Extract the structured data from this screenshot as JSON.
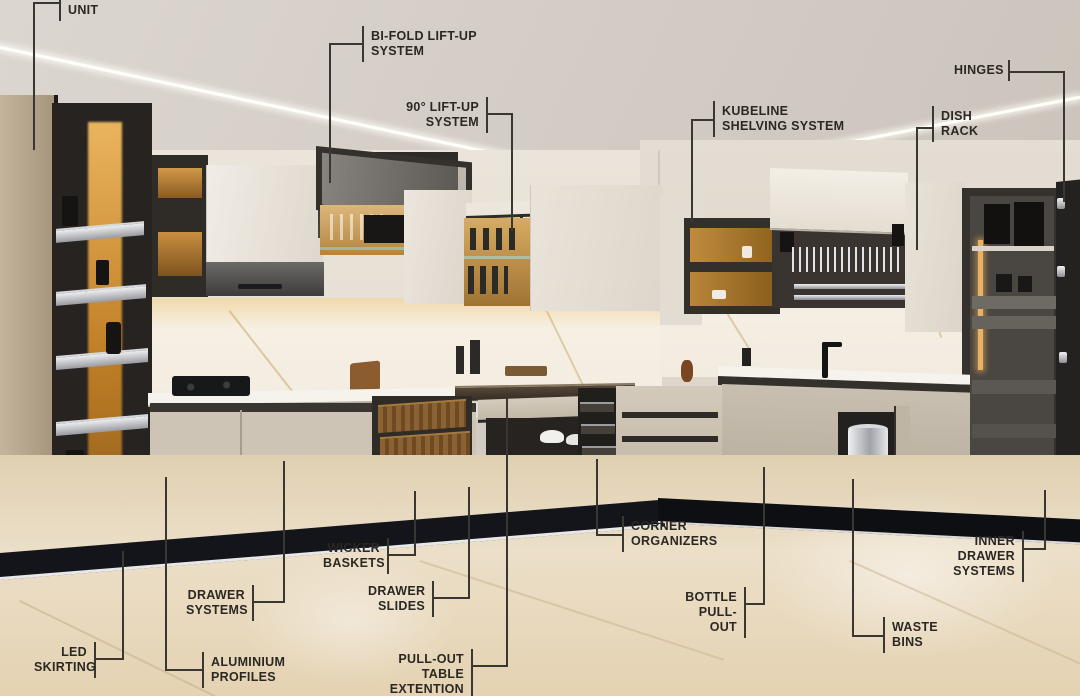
{
  "image": {
    "type": "annotated kitchen interior render",
    "description": "Modular kitchen with labeled hardware and storage systems"
  },
  "colors": {
    "label_text": "#2b2823",
    "leader_line": "#3a3631",
    "led_warm": "#e2a24f",
    "cabinet_cream": "#ccc3b4",
    "cabinet_dark_frame": "#2f2c28",
    "counter_white": "#f6f3ed",
    "floor_beige": "#e6d5b6",
    "skirting_black": "#14151a"
  },
  "annotations": [
    {
      "id": "unit",
      "label": "UNIT"
    },
    {
      "id": "bi-fold-lift-up-system",
      "label": "BI-FOLD LIFT-UP\nSYSTEM"
    },
    {
      "id": "90-lift-up-system",
      "label": "90° LIFT-UP\nSYSTEM"
    },
    {
      "id": "kubeline-shelving-system",
      "label": "KUBELINE\nSHELVING SYSTEM"
    },
    {
      "id": "hinges",
      "label": "HINGES"
    },
    {
      "id": "dish-rack",
      "label": "DISH\nRACK"
    },
    {
      "id": "led-skirting",
      "label": "LED\nSKIRTING"
    },
    {
      "id": "aluminium-profiles",
      "label": "ALUMINIUM\nPROFILES"
    },
    {
      "id": "drawer-systems",
      "label": "DRAWER\nSYSTEMS"
    },
    {
      "id": "wicker-baskets",
      "label": "WICKER\nBASKETS"
    },
    {
      "id": "drawer-slides",
      "label": "DRAWER\nSLIDES"
    },
    {
      "id": "pull-out-table-extention",
      "label": "PULL-OUT TABLE\nEXTENTION"
    },
    {
      "id": "corner-organizers",
      "label": "CORNER\nORGANIZERS"
    },
    {
      "id": "bottle-pull-out",
      "label": "BOTTLE\nPULL-OUT"
    },
    {
      "id": "waste-bins",
      "label": "WASTE\nBINS"
    },
    {
      "id": "inner-drawer-systems",
      "label": "INNER DRAWER\nSYSTEMS"
    }
  ]
}
